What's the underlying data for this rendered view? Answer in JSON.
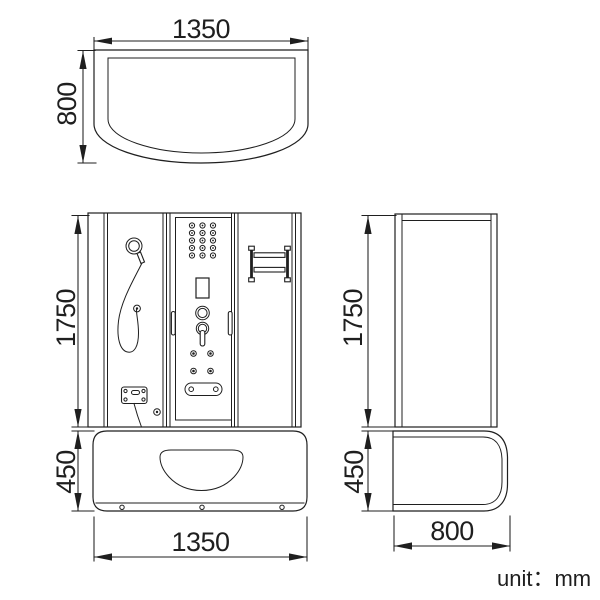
{
  "drawing": {
    "unit_note": "unit：mm",
    "colors": {
      "line": "#1f1f1f",
      "background": "#ffffff"
    },
    "views": {
      "top": {
        "label_width": "1350",
        "label_depth": "800"
      },
      "front": {
        "label_height": "1750",
        "label_base_height": "450",
        "label_width": "1350"
      },
      "side": {
        "label_height": "1750",
        "label_base_height": "450",
        "label_depth": "800"
      }
    }
  }
}
